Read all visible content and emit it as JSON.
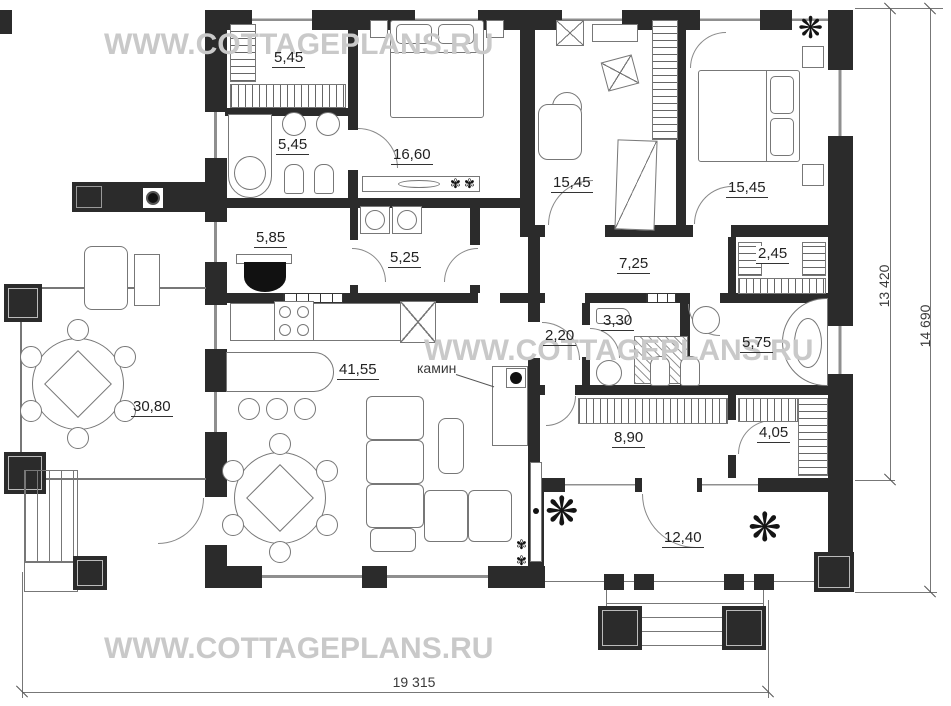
{
  "plan": {
    "watermark": "WWW.COTTAGEPLANS.RU",
    "fireplace_label": "камин",
    "rooms": [
      {
        "id": "wardrobe-1",
        "area": "5,45"
      },
      {
        "id": "bathroom-1",
        "area": "5,45"
      },
      {
        "id": "bedroom-1",
        "area": "16,60"
      },
      {
        "id": "office",
        "area": "15,45"
      },
      {
        "id": "bedroom-2",
        "area": "15,45"
      },
      {
        "id": "boiler-room",
        "area": "5,85"
      },
      {
        "id": "laundry",
        "area": "5,25"
      },
      {
        "id": "hallway",
        "area": "7,25"
      },
      {
        "id": "wardrobe-2",
        "area": "2,45"
      },
      {
        "id": "hall",
        "area": "2,20"
      },
      {
        "id": "shower-room",
        "area": "3,30"
      },
      {
        "id": "bathroom-2",
        "area": "5,75"
      },
      {
        "id": "living-room",
        "area": "41,55"
      },
      {
        "id": "terrace",
        "area": "30,80"
      },
      {
        "id": "entrance-hall",
        "area": "8,90"
      },
      {
        "id": "wardrobe-3",
        "area": "4,05"
      },
      {
        "id": "porch",
        "area": "12,40"
      }
    ],
    "dimensions": {
      "side_inner": "13 420",
      "side_outer": "14 690",
      "bottom": "19 315"
    },
    "icons": {
      "plant": "❋",
      "flower": "✾"
    },
    "colors": {
      "wall": "#2b2b2b",
      "furniture_line": "#777777",
      "watermark": "#c9c9c9",
      "label": "#222222"
    }
  }
}
